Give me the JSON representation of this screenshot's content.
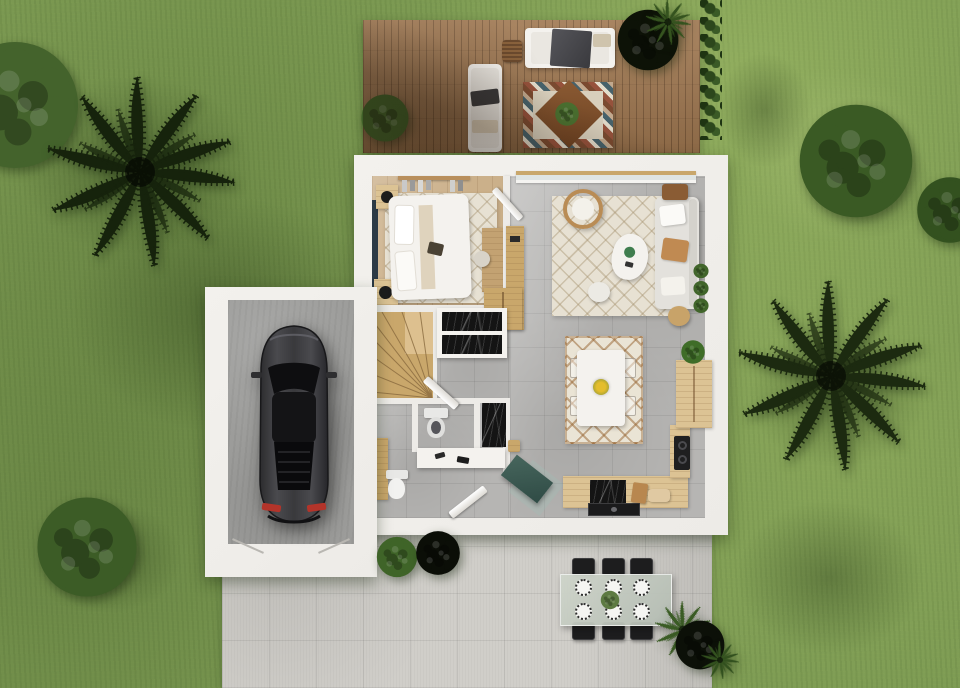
{
  "meta": {
    "title": "Top-down 3D floor plan render of a house with garden, deck, garage and patio",
    "view": "top-down orthographic render",
    "canvas": {
      "width_px": 960,
      "height_px": 688
    },
    "text_content": "none — image contains no visible text"
  },
  "palette": {
    "grass": "#7e9c54",
    "grass_shadow": "#53702f",
    "deck_wood": "#9f7750",
    "house_wall": "#edebe7",
    "bedroom_floor": "#cbb08a",
    "tile_floor": "#b6b5b3",
    "garage_floor": "#9c9c9a",
    "patio_concrete": "#d0cec9",
    "car_body": "#343436",
    "taillight_red": "#b3342a",
    "accent_wall_navy": "#2c3a46",
    "stair_wood": "#c9a76b",
    "counter_wood": "#dcc394",
    "rug_cream": "#e7e1d3",
    "marble_black": "#141414",
    "entry_mat_teal": "#47665d",
    "bush_green": "#3d5a26",
    "palm_dark": "#1c2a10"
  },
  "outdoor": {
    "lawn": "grass lawn surrounding the property",
    "deck": {
      "label": "wooden deck (top)",
      "furniture": [
        "white outdoor sofa with dark throw",
        "white chaise lounge",
        "multicolor diamond rug with center plant",
        "rattan lantern",
        "green potted plant",
        "dark-leaf potted plant"
      ]
    },
    "patio": {
      "label": "concrete patio (bottom)",
      "furniture": [
        "glass outdoor dining table",
        "six black chairs",
        "six place settings",
        "plant centerpiece",
        "green potted plant",
        "black-leaf potted plant",
        "corner plant cluster"
      ]
    },
    "vegetation": [
      "round tree top-left",
      "palm tree top-left",
      "round bush top-right",
      "small bush right edge",
      "palm tree right",
      "round bush bottom-left",
      "hedge right of deck"
    ]
  },
  "house": {
    "rooms": [
      {
        "id": "bedroom",
        "label": "bedroom",
        "floor": "light wood",
        "furniture": [
          "double bed",
          "two nightstands with black lamps",
          "clothes rack",
          "desk with chair",
          "cream lattice rug",
          "navy accent wall"
        ]
      },
      {
        "id": "living-room",
        "label": "living room",
        "floor": "gray tile",
        "furniture": [
          "sofa with pillows",
          "hanging rattan chair",
          "white coffee table",
          "wood sideboard",
          "side table",
          "tan pouf",
          "white pouf",
          "cream rug",
          "sliding glass door to deck",
          "plant beside sofa"
        ]
      },
      {
        "id": "hallway",
        "label": "hallway / landing",
        "floor": "gray tile",
        "furniture": [
          "winder staircase",
          "black marble wardrobe",
          "tall wood cabinet",
          "teal entry mat",
          "open doors"
        ]
      },
      {
        "id": "bathroom",
        "label": "bathroom",
        "floor": "gray tile",
        "furniture": [
          "toilet",
          "second toilet",
          "black marble shower",
          "white vanity counter",
          "wood cabinet"
        ]
      },
      {
        "id": "kitchen",
        "label": "kitchen",
        "floor": "gray tile",
        "furniture": [
          "L-shaped wood counter",
          "black cooktop",
          "black sink",
          "tall cabinet with plant",
          "cutting boards"
        ]
      },
      {
        "id": "dining",
        "label": "dining area",
        "floor": "gray tile",
        "furniture": [
          "white table",
          "four ghost chairs",
          "yellow flower centerpiece",
          "brown lattice rug"
        ]
      }
    ]
  },
  "garage": {
    "label": "garage",
    "floor": "concrete",
    "contents": [
      "dark gray car, top view, red taillights"
    ]
  }
}
